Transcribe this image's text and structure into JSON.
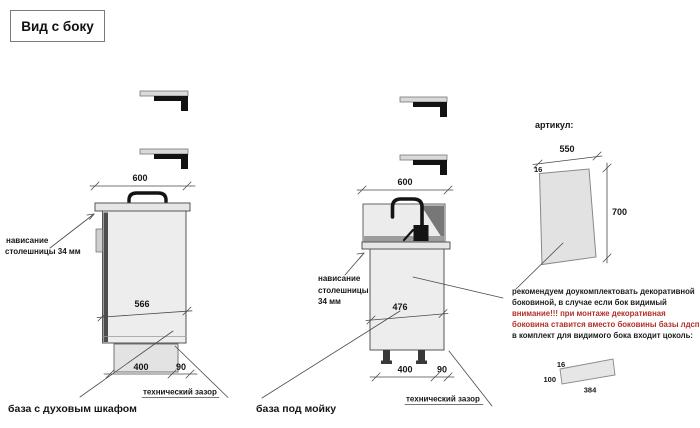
{
  "title_box": {
    "label": "Вид с боку"
  },
  "colors": {
    "warning_text": "#b03028",
    "drawing_line": "#4a4a4a",
    "fill_light": "#ededed"
  },
  "oven_base": {
    "caption": "база с духовым шкафом",
    "dim_top_width": "600",
    "dim_inner_depth": "566",
    "dim_plinth_inset": "400",
    "dim_tech_gap": "90",
    "overhang_line1": "нависание",
    "overhang_line2": "столешницы 34 мм",
    "tech_gap_label": "технический зазор"
  },
  "sink_base": {
    "caption": "база под мойку",
    "dim_top_width": "600",
    "dim_inner_depth": "476",
    "dim_plinth_inset": "400",
    "dim_tech_gap": "90",
    "overhang_line1": "нависание",
    "overhang_line2": "столешницы",
    "overhang_line3": "34 мм",
    "tech_gap_label": "технический зазор"
  },
  "side_panel": {
    "article_label": "артикул:",
    "dim_width": "550",
    "dim_thickness": "16",
    "dim_height": "700",
    "note_lines": [
      {
        "text": "рекомендуем доукомплектовать декоративной",
        "warn": false
      },
      {
        "text": "боковиной, в случае если бок видимый",
        "warn": false
      },
      {
        "text": "внимание!!! при монтаже декоративная",
        "warn": true
      },
      {
        "text": "боковина ставится вместо боковины базы лдсп",
        "warn": true
      },
      {
        "text": "в комплект для видимого бока входит цоколь:",
        "warn": false
      }
    ]
  },
  "plinth": {
    "dim_thickness": "16",
    "dim_height": "100",
    "dim_width": "384"
  }
}
